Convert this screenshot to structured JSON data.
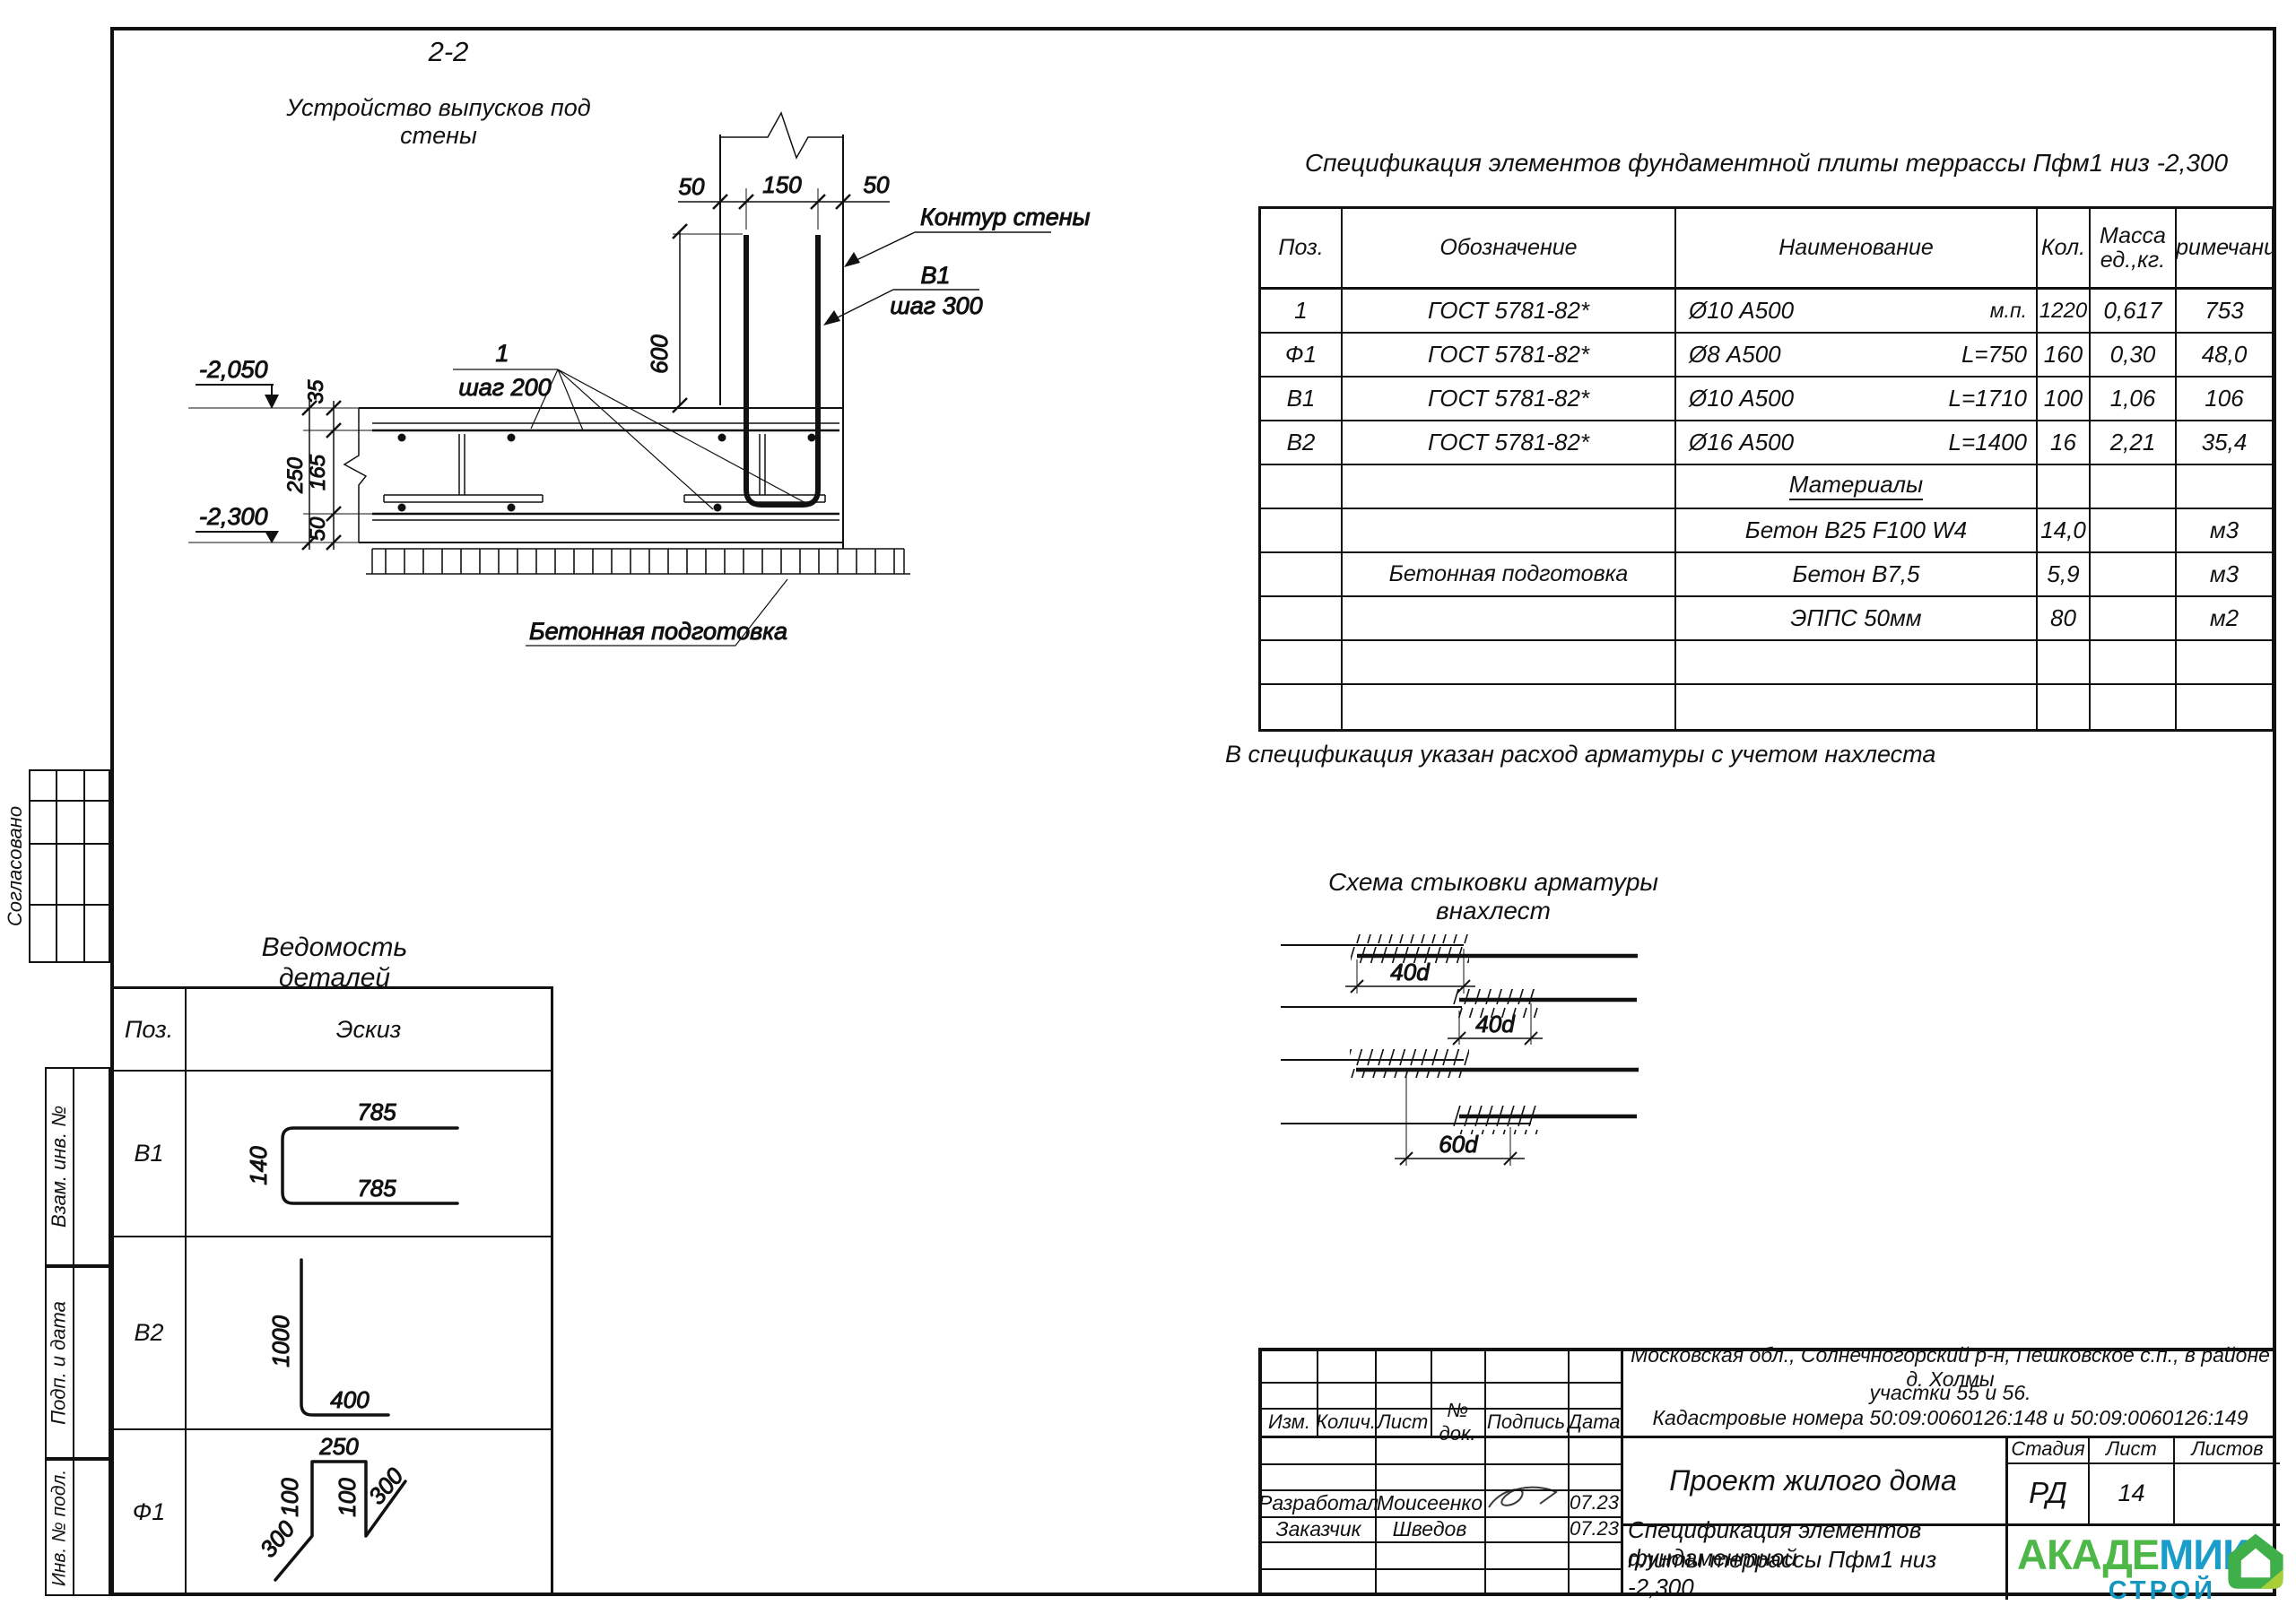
{
  "section": {
    "title": "2-2",
    "subtitle": "Устройство выпусков под стены",
    "wall_contour_label": "Контур стены",
    "b1_label": "В1",
    "b1_step": "шаг 300",
    "pos1_label": "1",
    "pos1_step": "шаг 200",
    "prep_label": "Бетонная подготовка",
    "dim_50_left": "50",
    "dim_150": "150",
    "dim_50_right": "50",
    "dim_600": "600",
    "dim_35": "35",
    "dim_250": "250",
    "dim_165": "165",
    "dim_50_bottom": "50",
    "elev_top": "-2,050",
    "elev_bottom": "-2,300"
  },
  "spec": {
    "title": "Спецификация элементов фундаментной плиты террассы Пфм1 низ -2,300",
    "col_pos": "Поз.",
    "col_designation": "Обозначение",
    "col_name": "Наименование",
    "col_qty": "Кол.",
    "col_mass_1": "Масса",
    "col_mass_2": "ед.,кг.",
    "col_note": "Примечание",
    "rows": [
      {
        "pos": "1",
        "designation": "ГОСТ 5781-82*",
        "name": "Ø10 А500",
        "detail": "м.п.",
        "qty": "1220",
        "mass": "0,617",
        "note": "753"
      },
      {
        "pos": "Ф1",
        "designation": "ГОСТ 5781-82*",
        "name": "Ø8 А500",
        "detail": "L=750",
        "qty": "160",
        "mass": "0,30",
        "note": "48,0"
      },
      {
        "pos": "В1",
        "designation": "ГОСТ 5781-82*",
        "name": "Ø10 А500",
        "detail": "L=1710",
        "qty": "100",
        "mass": "1,06",
        "note": "106"
      },
      {
        "pos": "В2",
        "designation": "ГОСТ 5781-82*",
        "name": "Ø16 А500",
        "detail": "L=1400",
        "qty": "16",
        "mass": "2,21",
        "note": "35,4"
      },
      {
        "group": "Материалы"
      },
      {
        "name": "Бетон В25 F100 W4",
        "qty": "14,0",
        "note": "м3"
      },
      {
        "designation": "Бетонная подготовка",
        "name": "Бетон В7,5",
        "qty": "5,9",
        "note": "м3"
      },
      {
        "name": "ЭППС 50мм",
        "qty": "80",
        "note": "м2"
      },
      {},
      {}
    ],
    "footnote": "В спецификация указан расход арматуры с учетом нахлеста"
  },
  "splice": {
    "title": "Схема стыковки арматуры внахлест",
    "lap1": "40d",
    "lap2": "40d",
    "stagger": "60d"
  },
  "details": {
    "title": "Ведомость деталей",
    "col_pos": "Поз.",
    "col_sketch": "Эскиз",
    "b1": {
      "pos": "В1",
      "len_top": "785",
      "len_bottom": "785",
      "height": "140"
    },
    "b2": {
      "pos": "В2",
      "len_vert": "1000",
      "len_horiz": "400"
    },
    "f1": {
      "pos": "Ф1",
      "len_top": "250",
      "len_left": "100",
      "len_right": "100",
      "len_diag_left": "300",
      "len_diag_right": "300"
    }
  },
  "side_stamps": {
    "agreed": "Согласовано",
    "replace_inv": "Взам. инв. №",
    "sign_date": "Подп. и дата",
    "inv_orig": "Инв. № подл."
  },
  "titleblock": {
    "address1": "Московская обл., Солнечногорский р-н, Пешковское с.п., в районе д. Холмы",
    "address2": "участки 55 и 56.",
    "address3": "Кадастровые номера 50:09:0060126:148 и 50:09:0060126:149",
    "col_izm": "Изм.",
    "col_kolich": "Колич.",
    "col_list": "Лист",
    "col_doc": "№ док.",
    "col_sign": "Подпись",
    "col_date": "Дата",
    "row1_role": "Разработал",
    "row1_name": "Моисеенко",
    "row1_date": "07.23",
    "row2_role": "Заказчик",
    "row2_name": "Шведов",
    "row2_date": "07.23",
    "project": "Проект жилого дома",
    "stage_label": "Стадия",
    "sheet_label": "Лист",
    "sheets_label": "Листов",
    "stage": "РД",
    "sheet_num": "14",
    "doc_line1": "Спецификация элементов фундаментной",
    "doc_line2": "плиты террассы Пфм1 низ -2,300"
  },
  "logo": {
    "word1a": "АКАДЕ",
    "word1b": "МИК",
    "word2": "СТРОЙ",
    "green": "#4db848",
    "blue": "#1b9dc9"
  }
}
